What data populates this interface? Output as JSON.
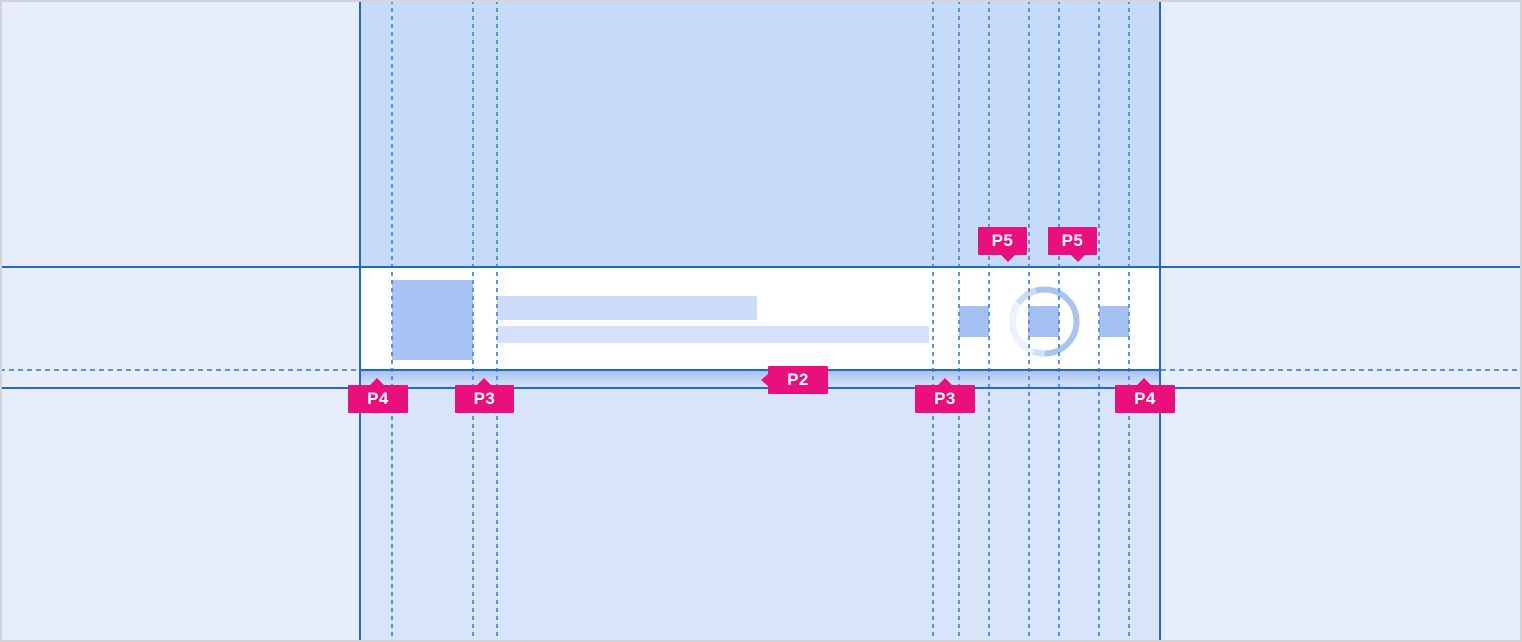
{
  "annotations": {
    "p4_left": {
      "label": "P4"
    },
    "p3_left": {
      "label": "P3"
    },
    "p2": {
      "label": "P2"
    },
    "p3_right": {
      "label": "P3"
    },
    "p4_right": {
      "label": "P4"
    },
    "p5_left": {
      "label": "P5"
    },
    "p5_right": {
      "label": "P5"
    }
  },
  "colors": {
    "annotation_badge": "#e9107e",
    "badge_text": "#ffffff",
    "guide_solid": "#2368d0",
    "guide_dashed": "#5b95dd",
    "canvas_margin": "#e8edfb",
    "band_above_row": "#c5dbf7",
    "band_below_row": "#d8e4fa",
    "row_background": "#ffffff",
    "row_shadow_start": "#a2bfee",
    "row_shadow_end": "#d6e2f9",
    "avatar_placeholder": "#a8c3f3",
    "title_bar_placeholder": "#cbdbf8",
    "subtitle_bar_placeholder": "#d5e1fa",
    "action_icon_placeholder": "#a5c1f2",
    "spinner_ring": "#a9c4f0",
    "spinner_ring_highlight": "#edf1fb",
    "frame_border": "#d2d4d9"
  }
}
